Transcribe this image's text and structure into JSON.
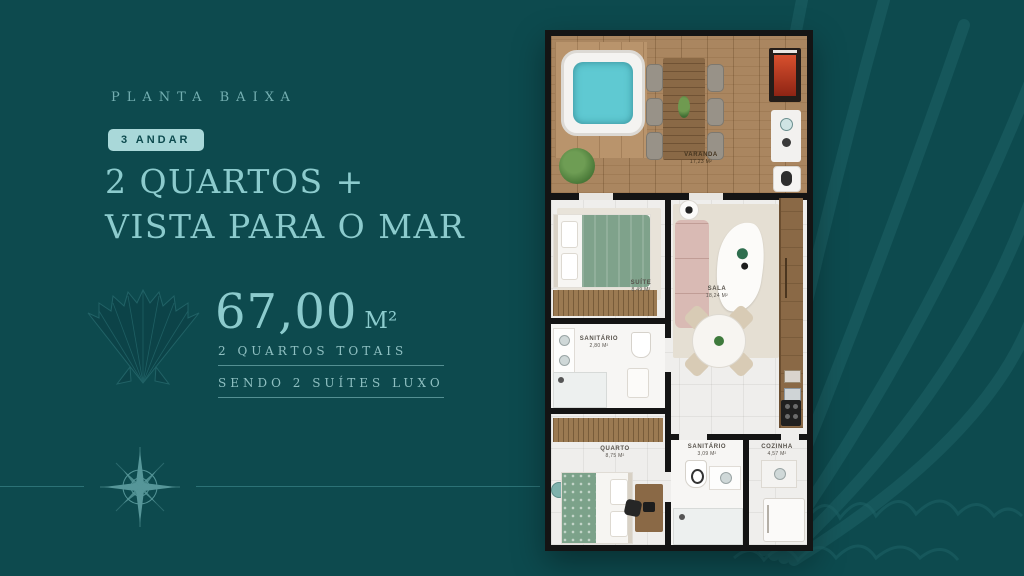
{
  "colors": {
    "background": "#0d4a4e",
    "accent": "#8ccbcd",
    "badge_bg": "#a9d8d9",
    "wall": "#141414"
  },
  "left_panel": {
    "eyebrow": "PLANTA BAIXA",
    "floor_badge": "3 ANDAR",
    "title_line1": "2 QUARTOS +",
    "title_line2": "VISTA PARA O MAR",
    "area_value": "67,00",
    "area_unit": "M²",
    "detail_line1": "2 QUARTOS TOTAIS",
    "detail_line2": "SENDO 2 SUÍTES LUXO"
  },
  "floor_plan": {
    "rooms": {
      "varanda": {
        "name": "VARANDA",
        "area": "17,23 M²"
      },
      "suite": {
        "name": "SUÍTE",
        "area": "8,49 M²"
      },
      "sala": {
        "name": "SALA",
        "area": "18,24 M²"
      },
      "sanitario1": {
        "name": "SANITÁRIO",
        "area": "2,80 M²"
      },
      "quarto": {
        "name": "QUARTO",
        "area": "8,75 M²"
      },
      "sanitario2": {
        "name": "SANITÁRIO",
        "area": "3,09 M²"
      },
      "cozinha": {
        "name": "COZINHA",
        "area": "4,57 M²"
      }
    }
  },
  "icons": {
    "shell": "scallop-shell",
    "compass": "compass-rose",
    "watermark": "shell-watermark"
  }
}
